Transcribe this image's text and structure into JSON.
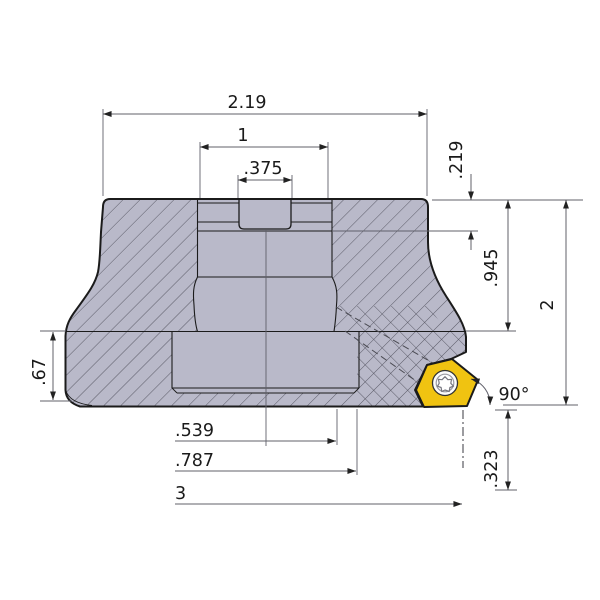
{
  "dims": {
    "overall_width": "2.19",
    "counterbore_diameter": "1",
    "keyway_width": ".375",
    "counterbore_depth": ".219",
    "body_height": ".945",
    "overall_height": "2",
    "flange_height": ".67",
    "approach_angle": "90°",
    "tip_offset": ".323",
    "bore_radius": ".539",
    "counterbore_radius": ".787",
    "cutting_diameter": "3"
  },
  "colors": {
    "body_gray": "#b9b9c9",
    "insert_yellow": "#f0c311",
    "outline": "#1b1b1b",
    "dimension_gray": "#60606a"
  }
}
